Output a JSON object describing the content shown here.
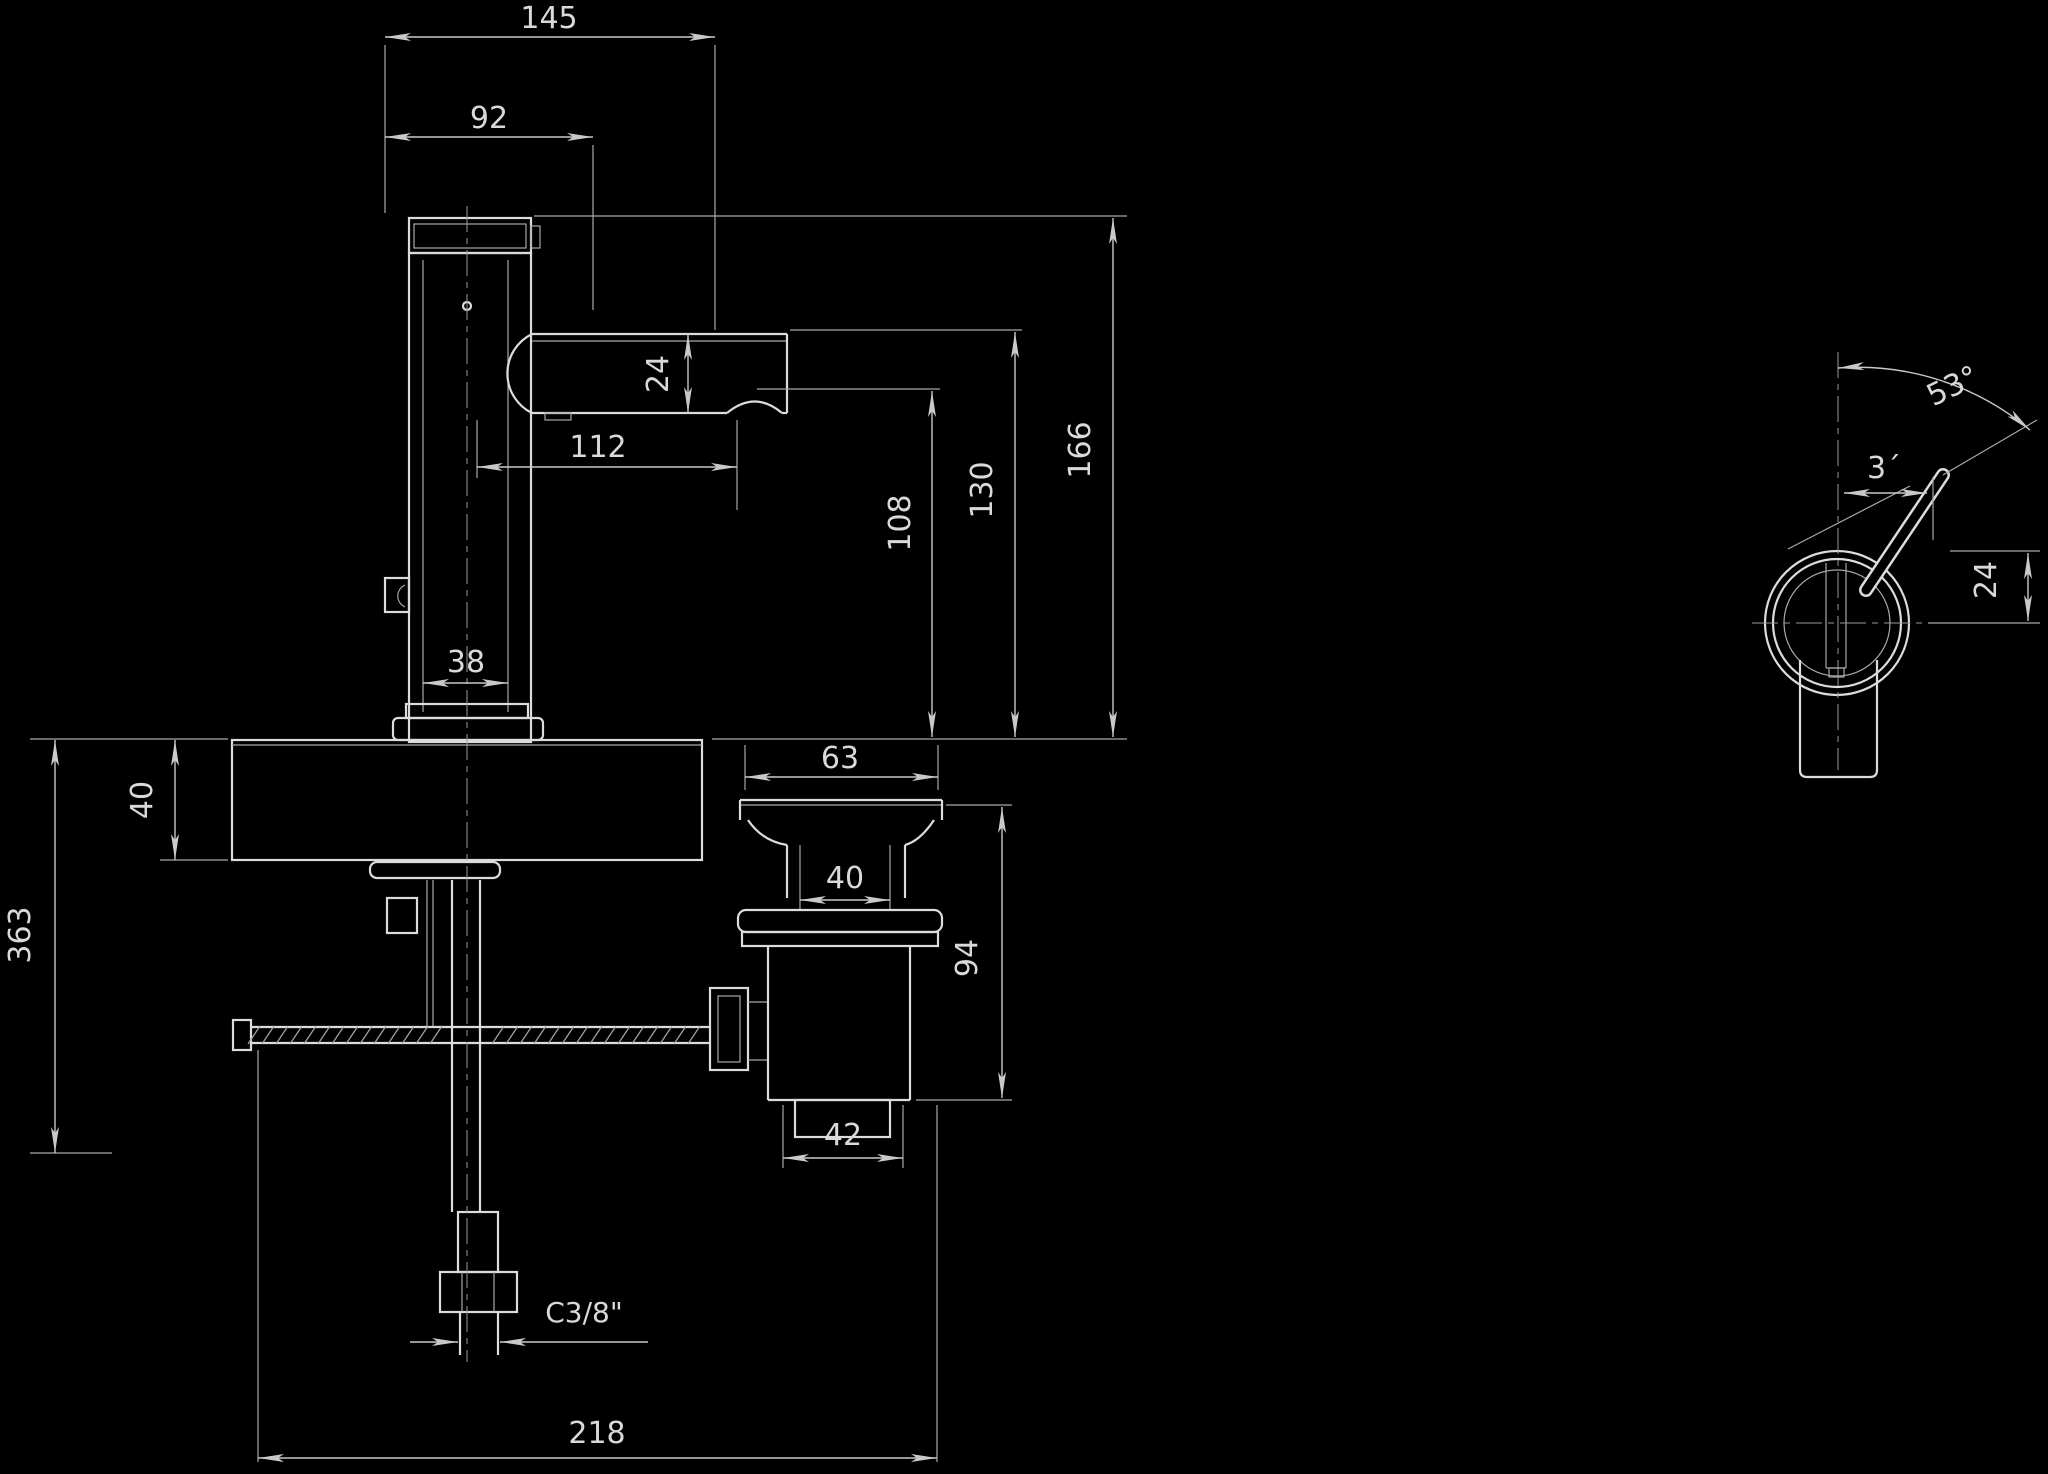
{
  "drawing_type": "faucet-technical-dimension-drawing",
  "colors": {
    "background": "#000000",
    "line": "#dcdcdc",
    "text": "#d9d9d9"
  },
  "dimensions": {
    "front": {
      "overall_width": "145",
      "handle_width": "92",
      "spout_tube_height": "24",
      "spout_reach": "112",
      "body_diameter": "38",
      "height_overall": "166",
      "height_spout_top": "130",
      "height_outlet": "108",
      "deck_thickness": "40",
      "below_deck_depth": "363",
      "base_span": "218",
      "supply_thread": "C3/8\""
    },
    "drain": {
      "flange_width": "63",
      "neck_width": "40",
      "height": "94",
      "body_width": "42"
    },
    "top_view": {
      "lever_angle": "53°",
      "lever_offset": "3´",
      "lever_depth": "24"
    }
  }
}
